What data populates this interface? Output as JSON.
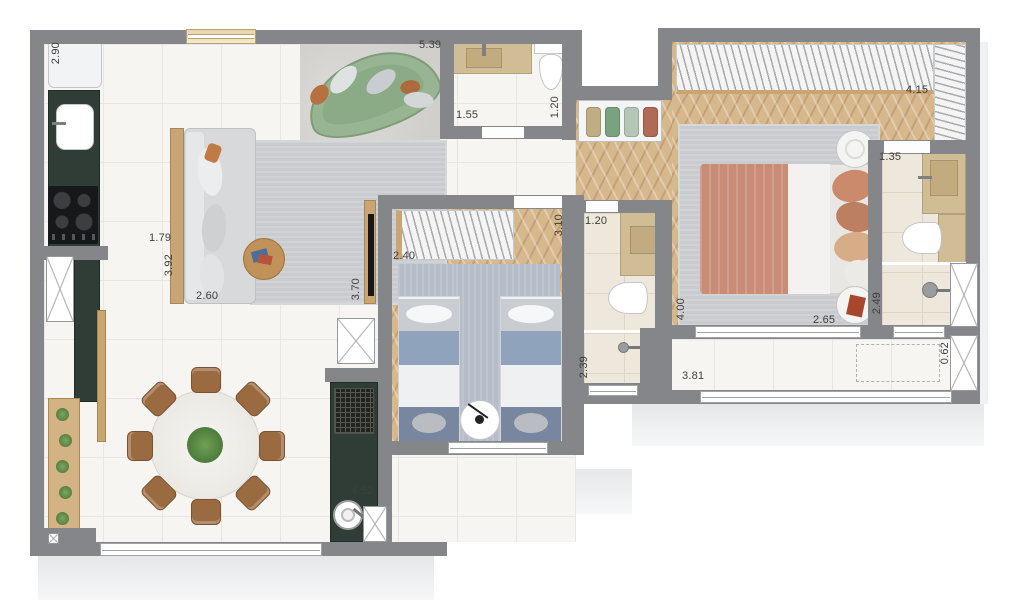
{
  "document": {
    "type": "apartment-floor-plan",
    "units": "meters"
  },
  "palette": {
    "wall": "#85868a",
    "green": "#2f3d36",
    "wood": "#c8a572",
    "woodfloor": "#d7b78c",
    "sofa_green": "#97b592",
    "bedblue": "#8fa3bc",
    "terracotta": "#c98d77",
    "label": "#3e3e3e"
  },
  "towel_colors": [
    "#c0ad83",
    "#79a27f",
    "#b3c6b8",
    "#b06a57"
  ],
  "dimension_labels": [
    {
      "text": "2.90",
      "x": 50,
      "y": 42,
      "vertical": true
    },
    {
      "text": "5.39",
      "x": 419,
      "y": 39,
      "vertical": false
    },
    {
      "text": "1.55",
      "x": 456,
      "y": 109,
      "vertical": false
    },
    {
      "text": "1.20",
      "x": 549,
      "y": 96,
      "vertical": true
    },
    {
      "text": "1.79",
      "x": 149,
      "y": 232,
      "vertical": false
    },
    {
      "text": "3.92",
      "x": 163,
      "y": 254,
      "vertical": true
    },
    {
      "text": "2.60",
      "x": 196,
      "y": 290,
      "vertical": false
    },
    {
      "text": "3.70",
      "x": 350,
      "y": 278,
      "vertical": true
    },
    {
      "text": "2.40",
      "x": 393,
      "y": 250,
      "vertical": false
    },
    {
      "text": "3.10",
      "x": 553,
      "y": 214,
      "vertical": true
    },
    {
      "text": "1.20",
      "x": 585,
      "y": 215,
      "vertical": false
    },
    {
      "text": "2.39",
      "x": 578,
      "y": 356,
      "vertical": true
    },
    {
      "text": "4.15",
      "x": 906,
      "y": 84,
      "vertical": false
    },
    {
      "text": "1.35",
      "x": 879,
      "y": 151,
      "vertical": false
    },
    {
      "text": "4.00",
      "x": 675,
      "y": 298,
      "vertical": true
    },
    {
      "text": "2.65",
      "x": 813,
      "y": 314,
      "vertical": false
    },
    {
      "text": "2.49",
      "x": 871,
      "y": 292,
      "vertical": true
    },
    {
      "text": "0.62",
      "x": 939,
      "y": 342,
      "vertical": true
    },
    {
      "text": "3.81",
      "x": 682,
      "y": 370,
      "vertical": false
    },
    {
      "text": "4.52",
      "x": 351,
      "y": 485,
      "vertical": false
    }
  ]
}
